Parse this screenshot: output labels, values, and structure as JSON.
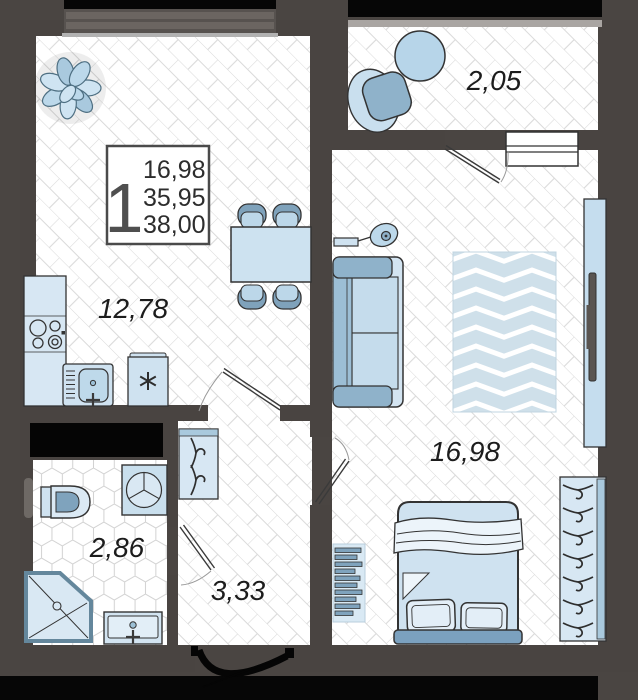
{
  "plan": {
    "info_box": {
      "room_count": "1",
      "area_living": "16,98",
      "area_no_balcony": "35,95",
      "area_total": "38,00"
    },
    "rooms": {
      "kitchen_living": {
        "area": "12,78"
      },
      "balcony": {
        "area": "2,05"
      },
      "bedroom": {
        "area": "16,98"
      },
      "bathroom": {
        "area": "2,86"
      },
      "hallway": {
        "area": "3,33"
      }
    },
    "palette": {
      "wall": "#494441",
      "shaft_black": "#060606",
      "floor_line": "#dadada",
      "furniture_light": "#d3e5f2",
      "furniture_mid": "#bcd7e9",
      "furniture_dark": "#7fa2bb",
      "rug": "#cfe0ea",
      "outline": "#333333"
    }
  }
}
